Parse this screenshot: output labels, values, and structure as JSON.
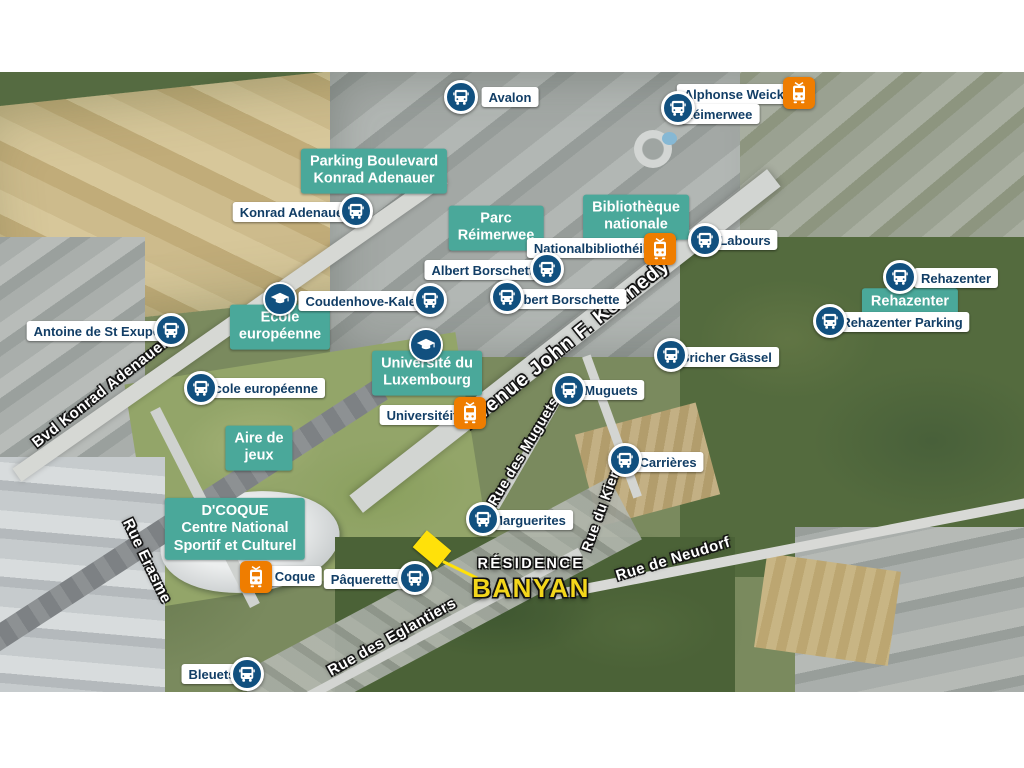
{
  "markers": {
    "bus_stops": [
      {
        "label": "Avalon"
      },
      {
        "label": "Alphonse Weicker",
        "label2": "Réimerwee"
      },
      {
        "label": "Konrad Adenauer"
      },
      {
        "label": "Labours"
      },
      {
        "label": "Albert Borschette"
      },
      {
        "label": "Albert Borschette"
      },
      {
        "label": "Rehazenter"
      },
      {
        "label": "Rehazenter Parking"
      },
      {
        "label": "Antoine de St Exupéry"
      },
      {
        "label": "Coudenhove-Kalergi"
      },
      {
        "label": "Ecole européenne"
      },
      {
        "label": "Muguets"
      },
      {
        "label": "Bricher Gässel"
      },
      {
        "label": "Carrières"
      },
      {
        "label": "Marguerites"
      },
      {
        "label": "Pâquerettes"
      },
      {
        "label": "Bleuets"
      }
    ],
    "tram_stops": [
      {
        "label": "Nationalbibliothéik"
      },
      {
        "label": "Universitéit"
      },
      {
        "label": "Coque"
      }
    ]
  },
  "poi_labels": [
    {
      "lines": [
        "Parking Boulevard",
        "Konrad Adenauer"
      ]
    },
    {
      "lines": [
        "Parc",
        "Réimerwee"
      ]
    },
    {
      "lines": [
        "Bibliothèque",
        "nationale"
      ]
    },
    {
      "lines": [
        "Rehazenter"
      ]
    },
    {
      "lines": [
        "Ecole",
        "européenne"
      ],
      "icon": "graduation-cap"
    },
    {
      "lines": [
        "Université du",
        "Luxembourg"
      ],
      "icon": "graduation-cap"
    },
    {
      "lines": [
        "Aire de",
        "jeux"
      ]
    },
    {
      "lines": [
        "D'COQUE",
        "Centre National",
        "Sportif et Culturel"
      ]
    }
  ],
  "street_labels": [
    {
      "text": "Bvd Konrad Adenauer"
    },
    {
      "text": "Rue Erasme"
    },
    {
      "text": "Avenue John F. Kennedy"
    },
    {
      "text": "Rue des Muguets"
    },
    {
      "text": "Rue du Kiem"
    },
    {
      "text": "Rue de Neudorf"
    },
    {
      "text": "Rue des Eglantiers"
    }
  ],
  "residence": {
    "line1": "RÉSIDENCE",
    "line2": "BANYAN"
  },
  "colors": {
    "bus_marker": "#11507f",
    "tram_marker": "#ef7d00",
    "poi_label_bg": "#4aa89a",
    "pill_text": "#123e66",
    "residence_yellow": "#f3d61b",
    "parcel_yellow": "#ffe10a"
  }
}
